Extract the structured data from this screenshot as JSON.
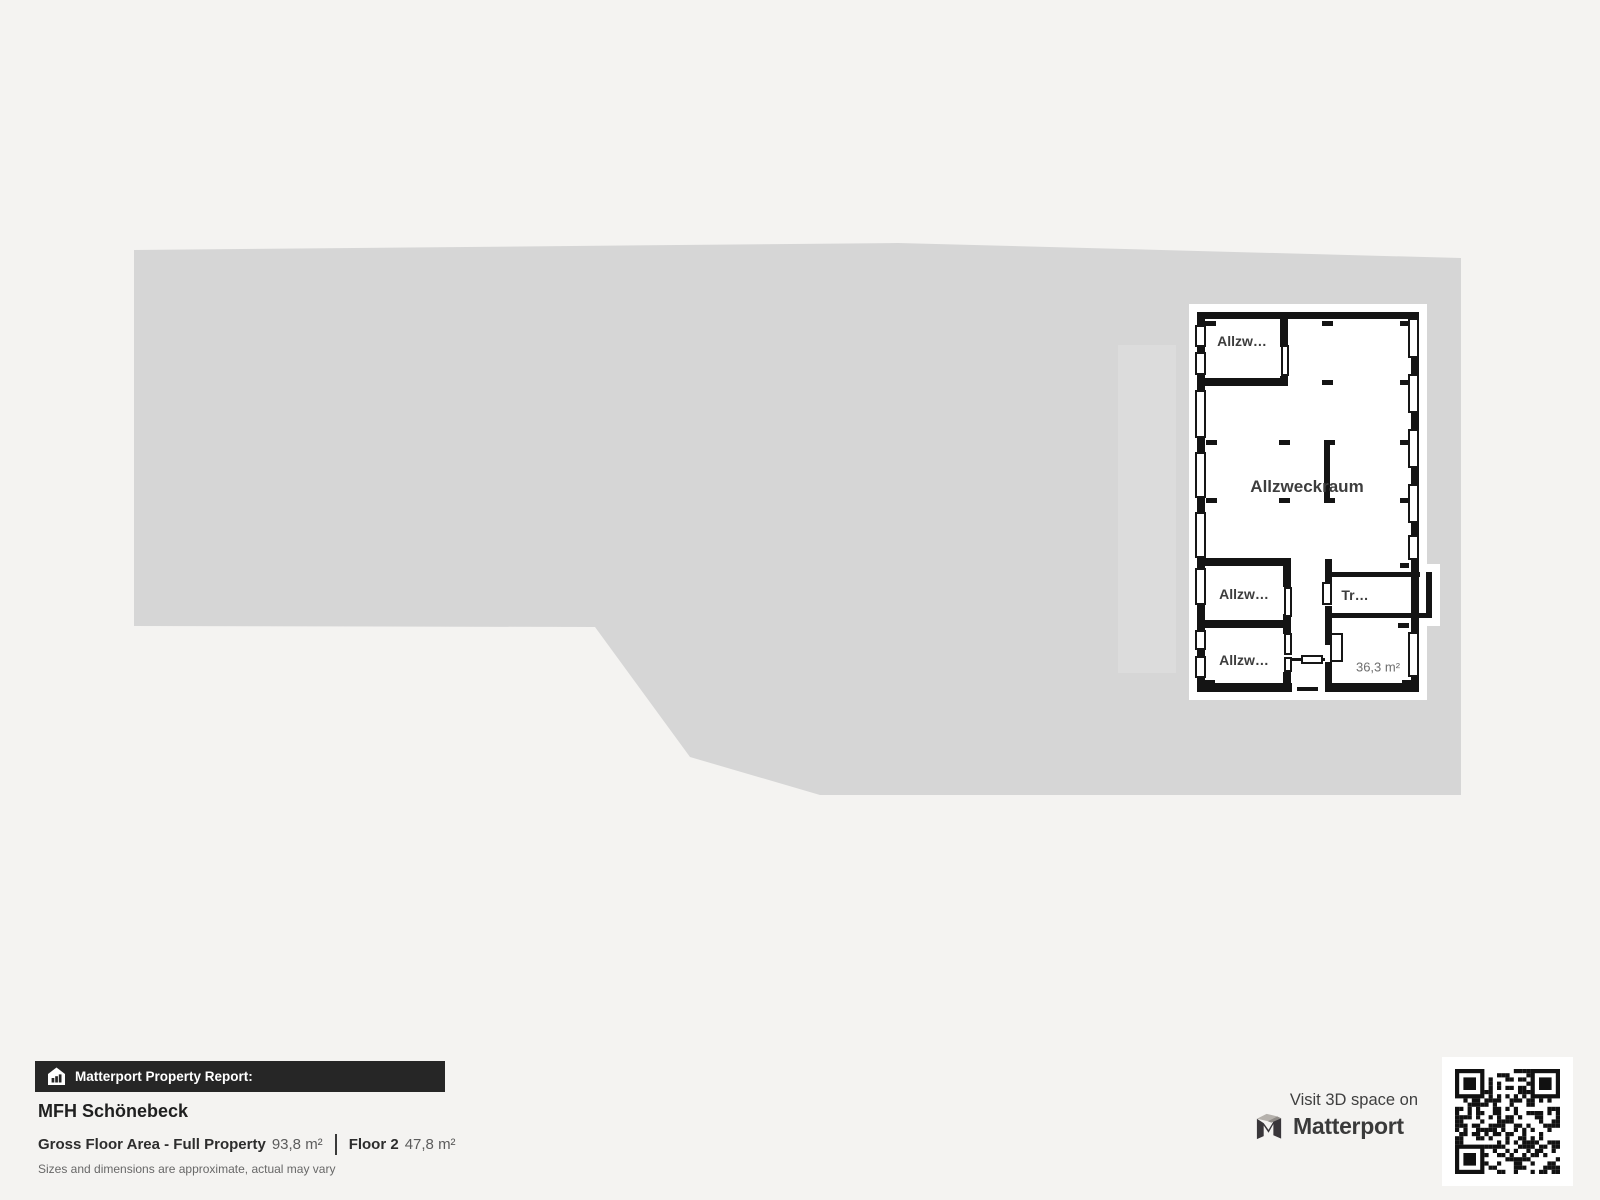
{
  "floor_plan": {
    "rooms": {
      "room_top": "Allzw…",
      "room_main": "Allzweckraum",
      "room_mid": "Allzw…",
      "room_bottom": "Allzw…",
      "room_stairs": "Tr…",
      "area_value": "36,3 m²"
    }
  },
  "report": {
    "bar_label": "Matterport Property Report:",
    "property_name": "MFH Schönebeck",
    "gfa_label": "Gross Floor Area - Full Property",
    "gfa_value": "93,8 m²",
    "floor_label": "Floor 2",
    "floor_value": "47,8 m²",
    "disclaimer": "Sizes and dimensions are approximate, actual may vary"
  },
  "promo": {
    "visit_text": "Visit 3D space on",
    "brand": "Matterport"
  },
  "colors": {
    "page_bg": "#f4f3f1",
    "lot_fill": "#d6d6d6",
    "ghost_fill": "#dcdcdc",
    "wall": "#141414",
    "bar_bg": "#262626"
  }
}
